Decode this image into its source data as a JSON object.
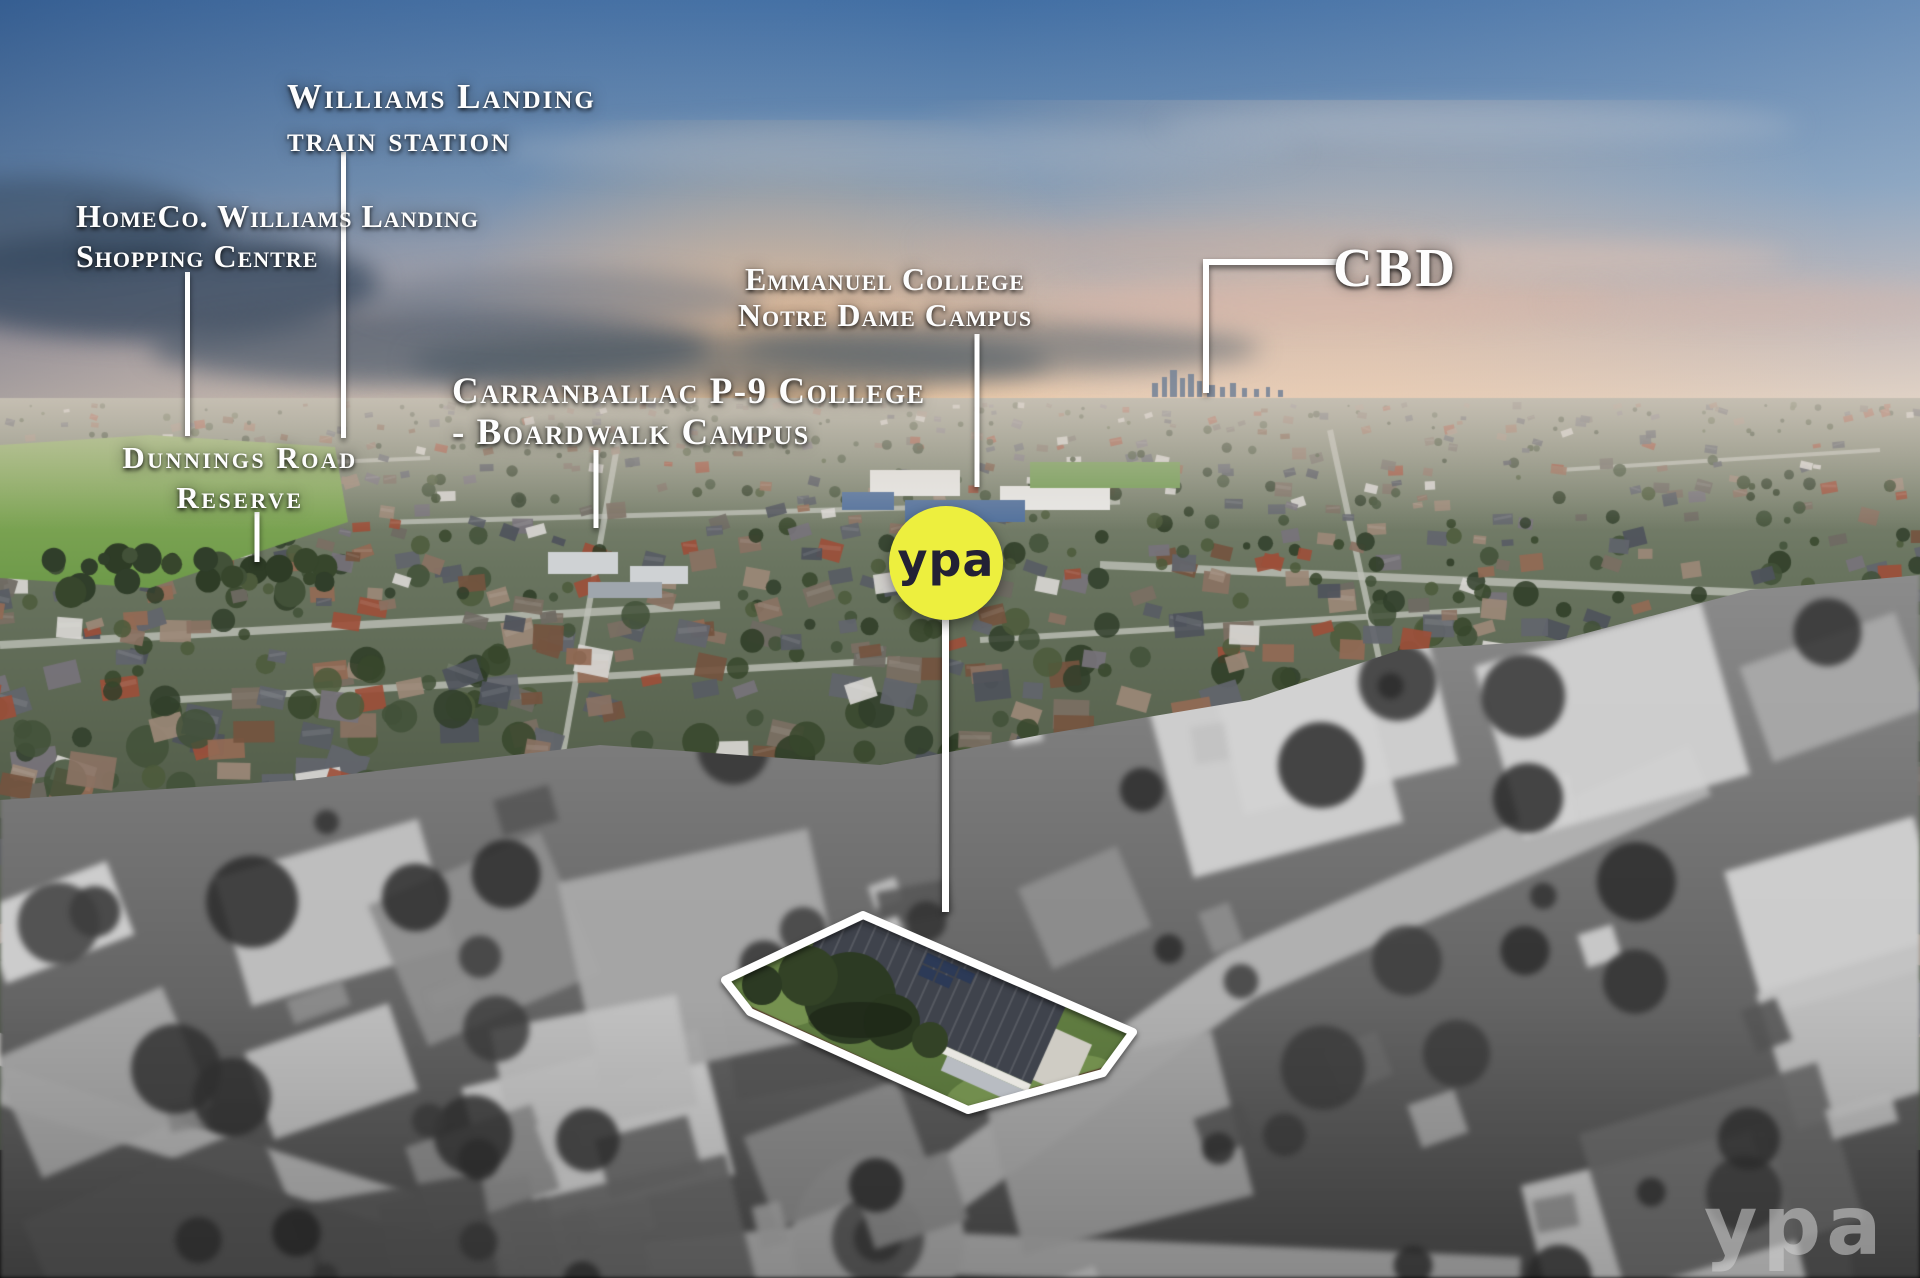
{
  "annotations": {
    "train_station": {
      "line1": "Williams Landing",
      "line2": "train station"
    },
    "shopping_centre": {
      "line1": "HomeCo. Williams Landing",
      "line2": "Shopping Centre"
    },
    "reserve": {
      "line1": "Dunnings Road",
      "line2": "Reserve"
    },
    "boardwalk_college": {
      "line1": "Carranballac P-9 College",
      "line2": "- Boardwalk Campus"
    },
    "notre_dame_college": {
      "line1": "Emmanuel College",
      "line2": "Notre Dame Campus"
    },
    "cbd": {
      "label": "CBD"
    }
  },
  "branding": {
    "agency_badge": "ypa",
    "watermark": "ypa",
    "badge_color": "#edef3e",
    "badge_text_color": "#232135",
    "annotation_color": "#ffffff"
  }
}
